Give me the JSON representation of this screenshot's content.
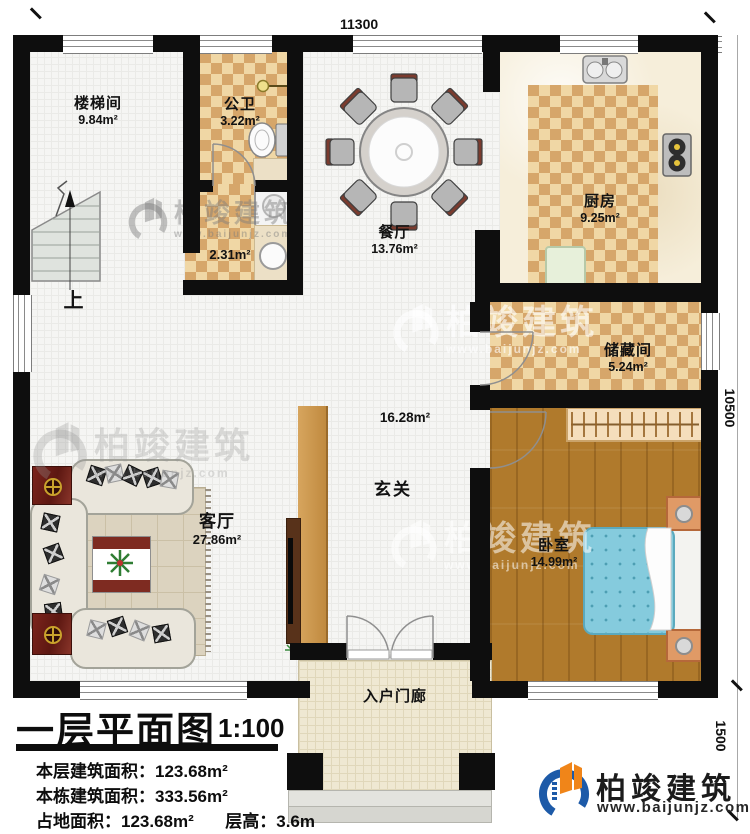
{
  "dimensions": {
    "width_top": "11300",
    "height_main": "10500",
    "height_porch": "1500"
  },
  "rooms": {
    "stairwell": {
      "name": "楼梯间",
      "area": "9.84m²"
    },
    "bathroom": {
      "name": "公卫",
      "area": "3.22m²"
    },
    "laundry": {
      "area": "2.31m²"
    },
    "dining": {
      "name": "餐厅",
      "area": "13.76m²"
    },
    "kitchen": {
      "name": "厨房",
      "area": "9.25m²"
    },
    "storage": {
      "name": "储藏间",
      "area": "5.24m²"
    },
    "hall": {
      "name": "玄关",
      "area": "16.28m²"
    },
    "living": {
      "name": "客厅",
      "area": "27.86m²"
    },
    "bedroom": {
      "name": "卧室",
      "area": "14.99m²"
    },
    "porch": {
      "name": "入户门廊"
    }
  },
  "stairs": {
    "up_label": "上"
  },
  "title_block": {
    "title": "一层平面图",
    "scale": "1:100",
    "stats": [
      {
        "label": "本层建筑面积：",
        "value": "123.68m²"
      },
      {
        "label": "本栋建筑面积：",
        "value": "333.56m²"
      },
      {
        "label": "占地面积：",
        "value": "123.68m²",
        "label2": "层高：",
        "value2": "3.6m"
      }
    ]
  },
  "brand": {
    "name": "柏竣建筑",
    "site": "www.baijunjz.com"
  },
  "watermark": {
    "name": "柏竣建筑",
    "site": "www.baijunjz.com"
  },
  "colors": {
    "wall": "#0e0e0e",
    "checker_dark": "#d6a66a",
    "checker_light": "#f0d7a5",
    "wood": "#b07a2c",
    "bed_blue": "#85cbdd",
    "brand_blue": "#1d5aa8",
    "brand_orange": "#f08519"
  }
}
